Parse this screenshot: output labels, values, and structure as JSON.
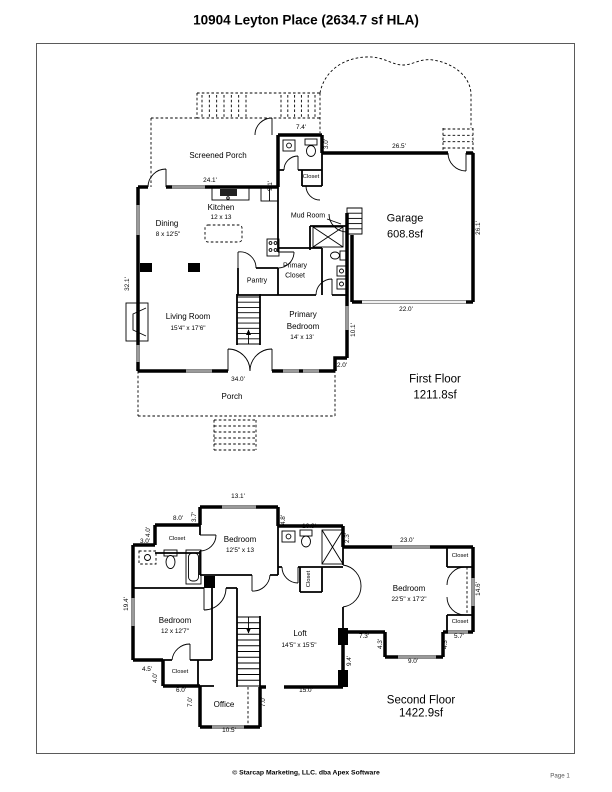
{
  "title": "10904 Leyton Place (2634.7 sf HLA)",
  "footer": {
    "copyright": "© Starcap Marketing, LLC. dba Apex Software",
    "page": "Page 1"
  },
  "first_floor": {
    "floor_name": "First Floor",
    "floor_area": "1211.8sf",
    "rooms": {
      "screened_porch": "Screened Porch",
      "closet_hall": "Closet",
      "kitchen": "Kitchen",
      "kitchen_size": "12 x 13",
      "dining": "Dining",
      "dining_size": "8 x 12'5\"",
      "mud_room": "Mud Room",
      "pantry": "Pantry",
      "primary_closet_1": "Primary",
      "primary_closet_2": "Closet",
      "living_room": "Living Room",
      "living_room_size": "15'4\" x 17'6\"",
      "primary_bedroom_1": "Primary",
      "primary_bedroom_2": "Bedroom",
      "primary_bedroom_size": "14' x 13'",
      "garage": "Garage",
      "garage_area": "608.8sf",
      "porch": "Porch"
    },
    "dims": [
      {
        "t": "7.4'",
        "x": 301,
        "y": 128
      },
      {
        "t": "9.1'",
        "x": 271,
        "y": 186,
        "r": -90
      },
      {
        "t": "3.0'",
        "x": 327,
        "y": 144,
        "r": -90
      },
      {
        "t": "24.1'",
        "x": 210,
        "y": 181
      },
      {
        "t": "26.5'",
        "x": 399,
        "y": 147
      },
      {
        "t": "26.1'",
        "x": 479,
        "y": 228,
        "r": -90
      },
      {
        "t": "22.0'",
        "x": 406,
        "y": 310
      },
      {
        "t": "32.1'",
        "x": 128,
        "y": 284,
        "r": -90
      },
      {
        "t": "10.1'",
        "x": 354,
        "y": 330,
        "r": -90
      },
      {
        "t": "2.0'",
        "x": 342,
        "y": 366
      },
      {
        "t": "34.0'",
        "x": 238,
        "y": 380
      }
    ]
  },
  "second_floor": {
    "floor_name": "Second Floor",
    "floor_area": "1422.9sf",
    "rooms": {
      "bedroom_top": "Bedroom",
      "bedroom_top_size": "12'5\" x 13",
      "closet_top_left": "Closet",
      "closet_hall": "Closet",
      "bedroom_right": "Bedroom",
      "bedroom_right_size": "22'5\" x 17'2\"",
      "closet_right_top": "Closet",
      "closet_right_bottom": "Closet",
      "bedroom_left": "Bedroom",
      "bedroom_left_size": "12 x 12'7\"",
      "closet_bottom_left": "Closet",
      "loft": "Loft",
      "loft_size": "14'5\" x 15'5\"",
      "office": "Office"
    },
    "dims": [
      {
        "t": "13.1'",
        "x": 238,
        "y": 497
      },
      {
        "t": "8.0'",
        "x": 178,
        "y": 519
      },
      {
        "t": "3.7'",
        "x": 195,
        "y": 517,
        "r": -90
      },
      {
        "t": "4.0'",
        "x": 149,
        "y": 532,
        "r": -90
      },
      {
        "t": "3.0'",
        "x": 145,
        "y": 542
      },
      {
        "t": "4.8'",
        "x": 284,
        "y": 520,
        "r": -90
      },
      {
        "t": "10.9'",
        "x": 309,
        "y": 527
      },
      {
        "t": "2.3'",
        "x": 348,
        "y": 538,
        "r": -90
      },
      {
        "t": "23.0'",
        "x": 407,
        "y": 541
      },
      {
        "t": "14.6'",
        "x": 479,
        "y": 589,
        "r": -90
      },
      {
        "t": "19.4'",
        "x": 127,
        "y": 604,
        "r": -90
      },
      {
        "t": "7.3'",
        "x": 364,
        "y": 637
      },
      {
        "t": "4.3'",
        "x": 381,
        "y": 644,
        "r": -90
      },
      {
        "t": "9.0'",
        "x": 413,
        "y": 662
      },
      {
        "t": "4.3'",
        "x": 446,
        "y": 644,
        "r": -90
      },
      {
        "t": "5.7'",
        "x": 459,
        "y": 637
      },
      {
        "t": "9.4'",
        "x": 350,
        "y": 661,
        "r": -90
      },
      {
        "t": "4.5'",
        "x": 147,
        "y": 670
      },
      {
        "t": "4.0'",
        "x": 156,
        "y": 678,
        "r": -90
      },
      {
        "t": "6.0'",
        "x": 181,
        "y": 691
      },
      {
        "t": "7.0'",
        "x": 191,
        "y": 702,
        "r": -90
      },
      {
        "t": "7.0'",
        "x": 264,
        "y": 702,
        "r": -90
      },
      {
        "t": "10.5'",
        "x": 229,
        "y": 731
      },
      {
        "t": "15.0'",
        "x": 306,
        "y": 691
      }
    ]
  }
}
